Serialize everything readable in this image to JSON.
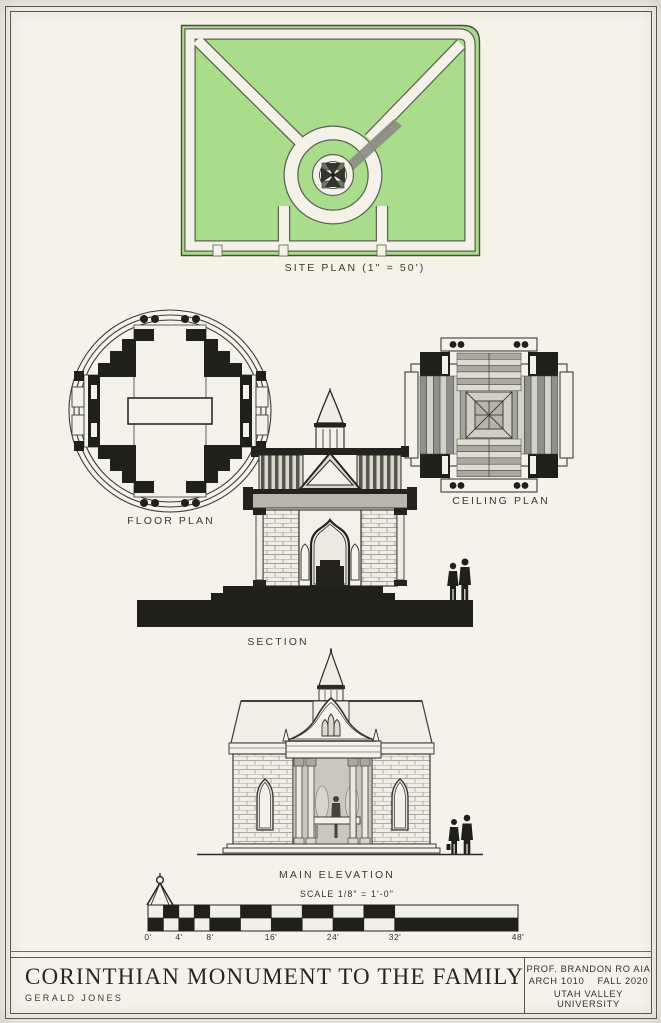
{
  "sheet": {
    "type": "architectural presentation board"
  },
  "drawings": {
    "site_plan": {
      "label": "SITE PLAN (1\" = 50')"
    },
    "floor_plan": {
      "label": "FLOOR PLAN"
    },
    "ceiling_plan": {
      "label": "CEILING PLAN"
    },
    "section": {
      "label": "SECTION"
    },
    "main_elevation": {
      "label": "MAIN ELEVATION"
    }
  },
  "scale_bar": {
    "caption": "SCALE  1/8\" = 1'-0\"",
    "ticks": [
      "0'",
      "4'",
      "8'",
      "16'",
      "24'",
      "32'",
      "48'"
    ]
  },
  "title_block": {
    "title": "CORINTHIAN MONUMENT TO THE FAMILY",
    "author": "GERALD JONES",
    "professor": "PROF. BRANDON RO AIA",
    "course": "ARCH 1010",
    "term": "FALL 2020",
    "school": "UTAH VALLEY UNIVERSITY"
  },
  "icons": {
    "compass": "drafting-compass-icon",
    "figures": "pedestrian-silhouettes"
  },
  "colors": {
    "paper": "#f4f2e9",
    "ink": "#26251f",
    "black_fill": "#20201b",
    "grass_green": "#a9dd8c",
    "shadow_gray": "#8b8d83",
    "stone_gray": "#b7b6aa"
  }
}
